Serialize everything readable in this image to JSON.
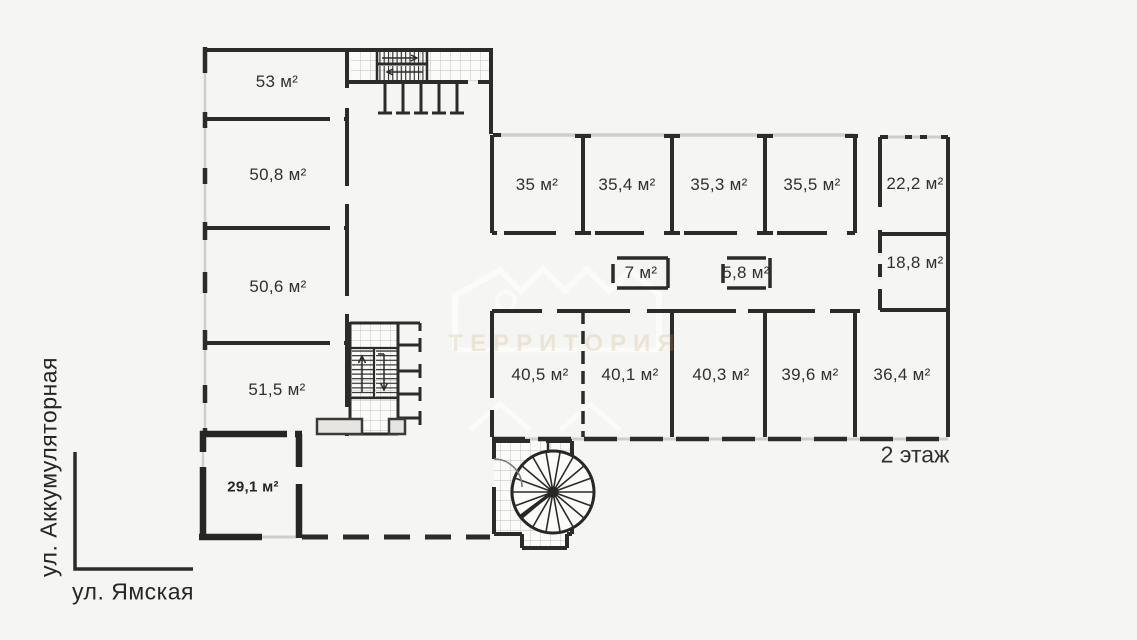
{
  "floor_label": "2 этаж",
  "streets": {
    "left": "ул. Аккумуляторная",
    "bottom": "ул. Ямская"
  },
  "watermark": {
    "text": "ТЕРРИТОРИЯ"
  },
  "rooms": [
    {
      "label": "53 м²"
    },
    {
      "label": "50,8 м²"
    },
    {
      "label": "50,6 м²"
    },
    {
      "label": "51,5 м²"
    },
    {
      "label": "29,1 м²"
    },
    {
      "label": "35 м²"
    },
    {
      "label": "35,4 м²"
    },
    {
      "label": "35,3 м²"
    },
    {
      "label": "35,5 м²"
    },
    {
      "label": "22,2 м²"
    },
    {
      "label": "7 м²"
    },
    {
      "label": "5,8 м²"
    },
    {
      "label": "18,8 м²"
    },
    {
      "label": "40,5 м²"
    },
    {
      "label": "40,1 м²"
    },
    {
      "label": "40,3 м²"
    },
    {
      "label": "39,6 м²"
    },
    {
      "label": "36,4 м²"
    }
  ],
  "colors": {
    "background": "#f5f5f3",
    "wall": "#2b2b29",
    "glazing": "#cfcfca",
    "tile_grid": "#cac9c5",
    "landing_fill": "#e6e5e1",
    "watermark_text": "#c9a96e"
  }
}
